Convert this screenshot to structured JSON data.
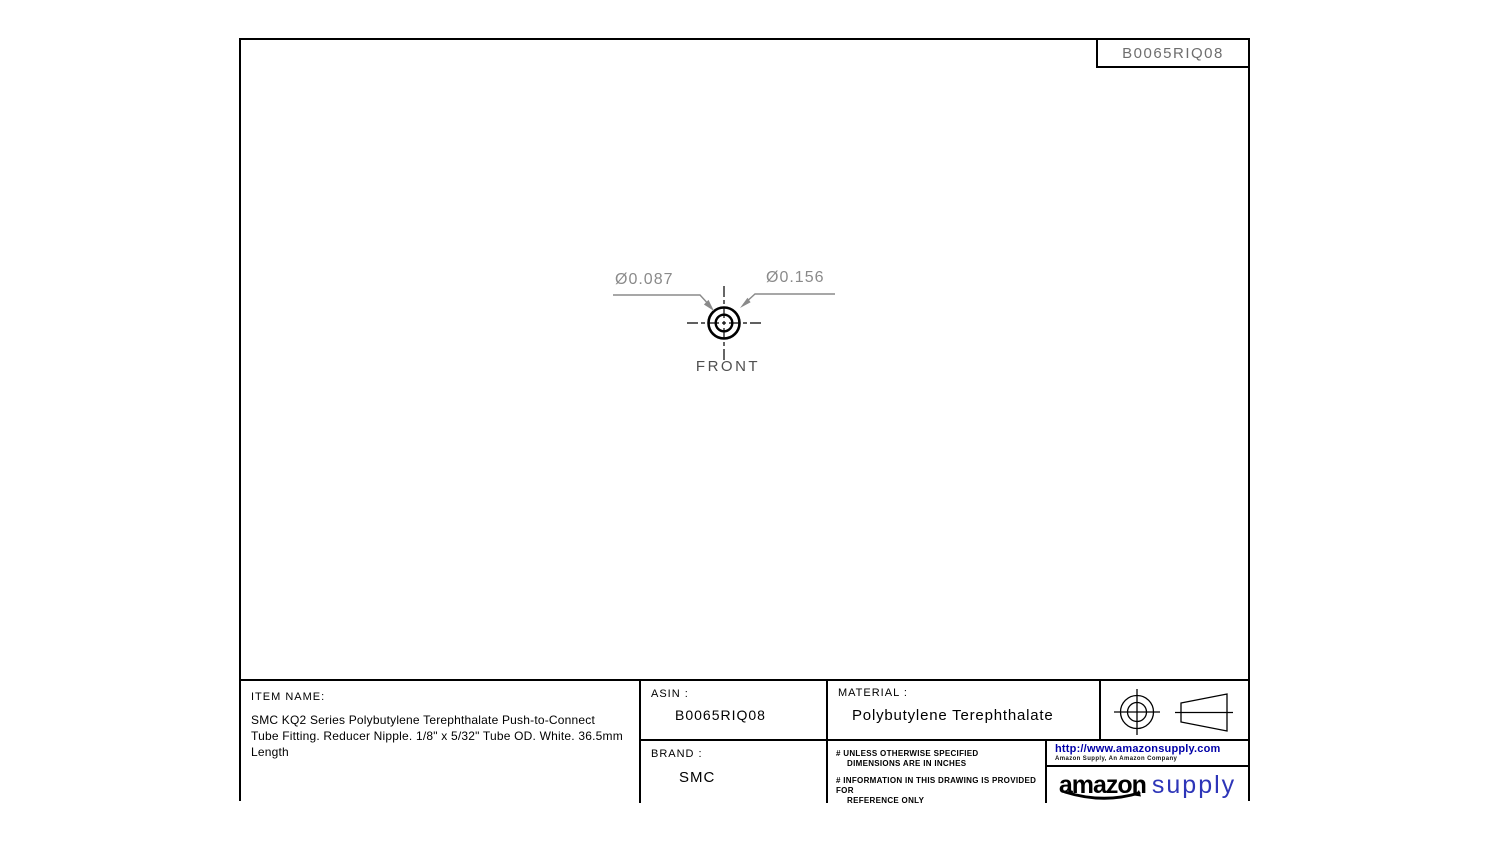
{
  "sheet": {
    "drawing_number_top": "B0065RIQ08",
    "view": {
      "label": "FRONT",
      "dim_inner_diameter": "Ø0.087",
      "dim_outer_diameter": "Ø0.156"
    },
    "title_block": {
      "item_name_label": "ITEM NAME:",
      "item_name": "SMC KQ2 Series Polybutylene Terephthalate Push-to-Connect Tube Fitting. Reducer Nipple. 1/8\" x 5/32\" Tube OD. White. 36.5mm Length",
      "asin_label": "ASIN :",
      "asin": "B0065RIQ08",
      "brand_label": "BRAND :",
      "brand": "SMC",
      "material_label": "MATERIAL :",
      "material": "Polybutylene Terephthalate",
      "notes": [
        {
          "line1": "# UNLESS OTHERWISE SPECIFIED",
          "line2": "DIMENSIONS ARE IN INCHES"
        },
        {
          "line1": "# INFORMATION IN THIS DRAWING IS PROVIDED FOR",
          "line2": "REFERENCE ONLY"
        }
      ],
      "url": "http://www.amazonsupply.com",
      "company_line": "Amazon Supply, An Amazon Company",
      "logo_amazon": "amazon",
      "logo_supply": "supply"
    },
    "colors": {
      "line_black": "#000000",
      "dimension_gray": "#8a8a8a",
      "front_label_gray": "#4f4f4f",
      "url_blue": "#0000a8",
      "supply_blue": "#2d35b8"
    }
  }
}
